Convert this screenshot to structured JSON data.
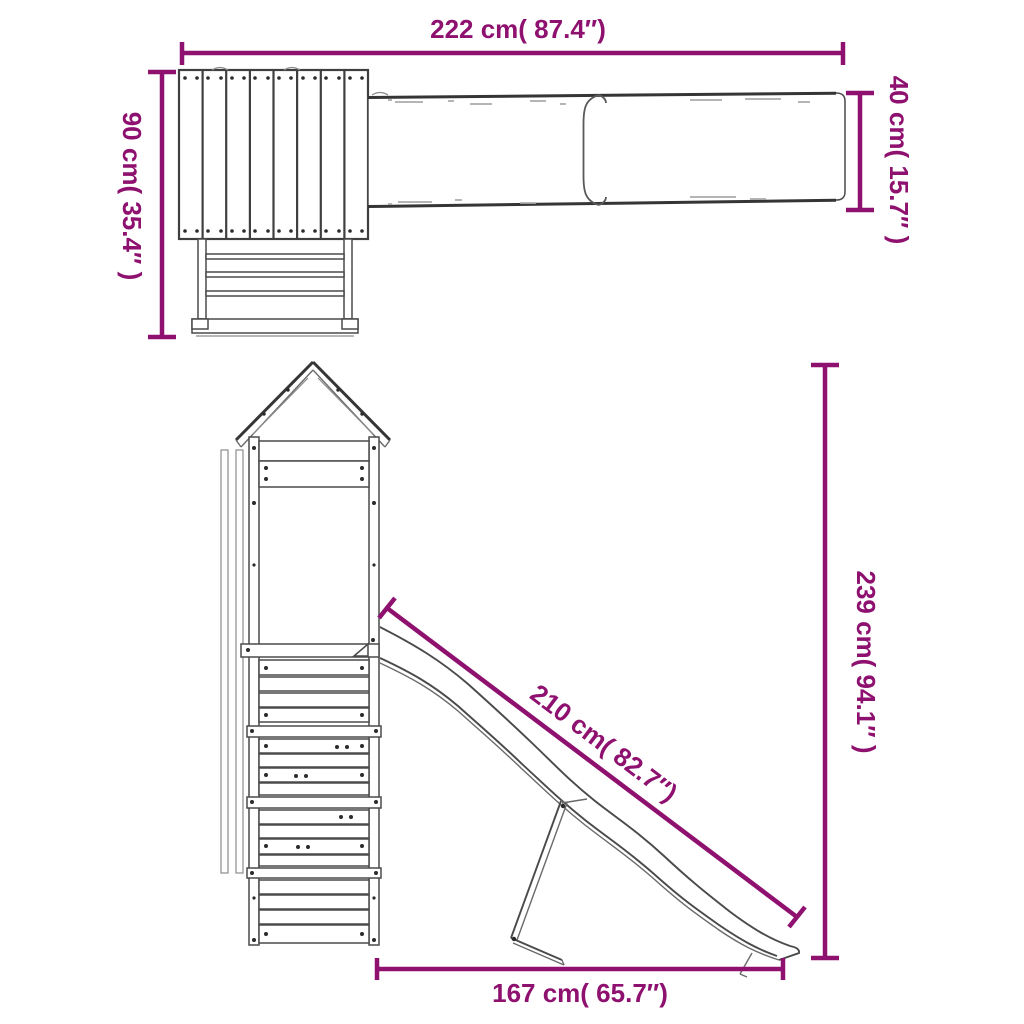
{
  "colors": {
    "accent": "#8E116F",
    "line": "#3F3F3F",
    "background": "#FFFFFF"
  },
  "top_view": {
    "overall_width": {
      "cm": "222",
      "in": "87.4",
      "label": "222 cm( 87.4″)"
    },
    "tower_depth": {
      "cm": "90",
      "in": "35.4",
      "label": "90 cm( 35.4″ )"
    },
    "slide_width": {
      "cm": "40",
      "in": "15.7",
      "label": "40 cm( 15.7″ )"
    }
  },
  "side_view": {
    "slide_length": {
      "cm": "210",
      "in": "82.7",
      "label": "210 cm( 82.7″)"
    },
    "overall_height": {
      "cm": "239",
      "in": "94.1",
      "label": "239 cm( 94.1″ )"
    },
    "base_length": {
      "cm": "167",
      "in": "65.7",
      "label": "167 cm( 65.7″)"
    }
  }
}
